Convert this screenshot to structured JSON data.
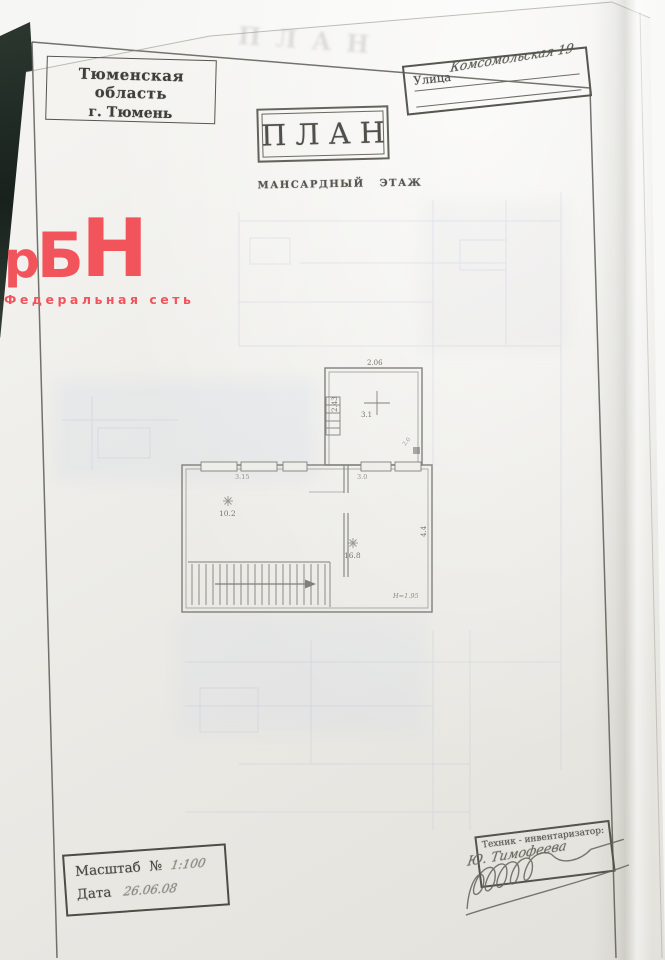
{
  "document": {
    "region_stamp": {
      "line1": "Тюменская область",
      "line2": "г. Тюмень"
    },
    "street_stamp": {
      "label": "Улица",
      "value": "Комсомольская 19"
    },
    "title_stamp": "ПЛАН",
    "ghost_title": "ПЛАН",
    "subtitle": "МАНСАРДНЫЙ ЭТАЖ",
    "scale_stamp": {
      "scale_label": "Масштаб",
      "number_sign": "№",
      "scale_value": "1:100",
      "date_label": "Дата",
      "date_value": "26.06.08"
    },
    "technician_stamp": {
      "label": "Техник - инвентаризатор:",
      "signature_name": "Ю. Тимофеева"
    }
  },
  "watermark": {
    "letter_p": "р",
    "letter_b": "Б",
    "letter_n": "Н",
    "subtitle": "Федеральная сеть",
    "color": "#f2545c"
  },
  "floor_plan": {
    "labels": {
      "dim_upper_width": "2.06",
      "dim_upper_height": "2.43",
      "room_upper": "3.1",
      "door_note": "2.0",
      "dim_left_width": "3.15",
      "dim_right_width": "3.0",
      "dim_right_height": "4.4",
      "room_left": "10.2",
      "room_right": "16.8",
      "height_note": "Н=1.95"
    }
  }
}
